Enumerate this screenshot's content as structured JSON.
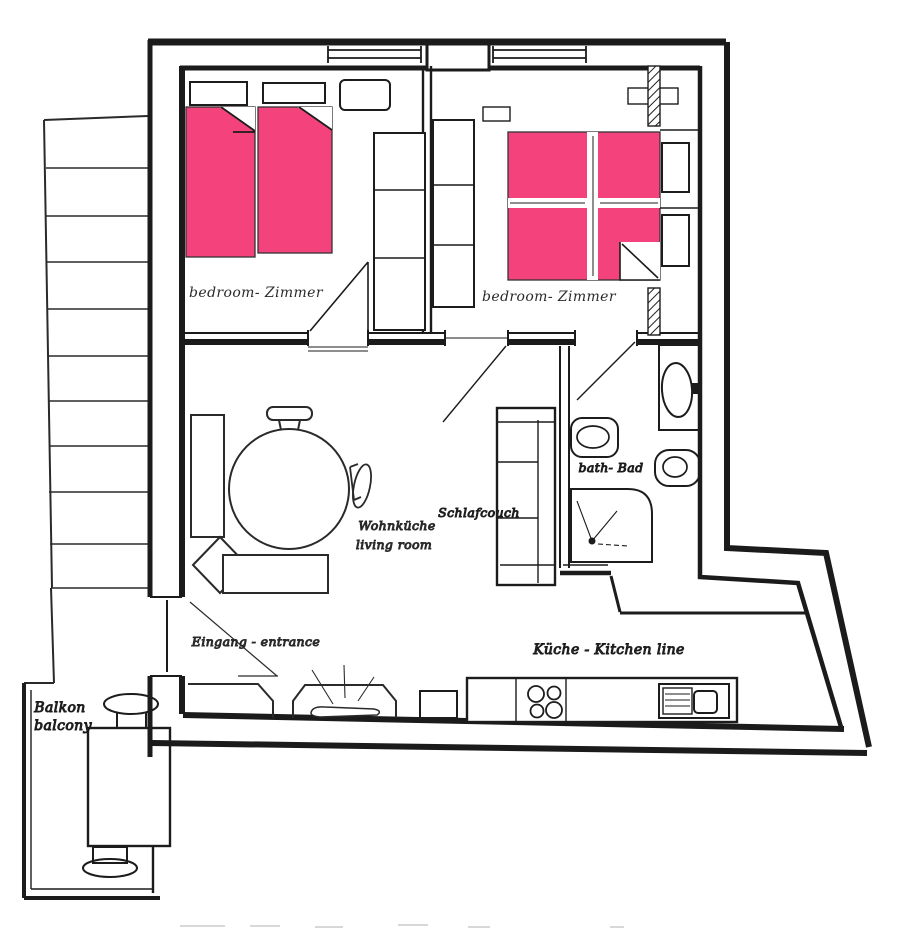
{
  "title": "Apartment floor plan sketch",
  "highlight_color": "#f4437c",
  "labels": {
    "bedroom_left": "bedroom- Zimmer",
    "bedroom_right": "bedroom- Zimmer",
    "bath": "bath- Bad",
    "living_line1": "Wohnküche",
    "living_line2": "living room",
    "sleepcouch": "Schlafcouch",
    "entrance": "Eingang - entrance",
    "kitchen": "Küche - Kitchen line",
    "balcony_line1": "Balkon",
    "balcony_line2": "balcony"
  }
}
